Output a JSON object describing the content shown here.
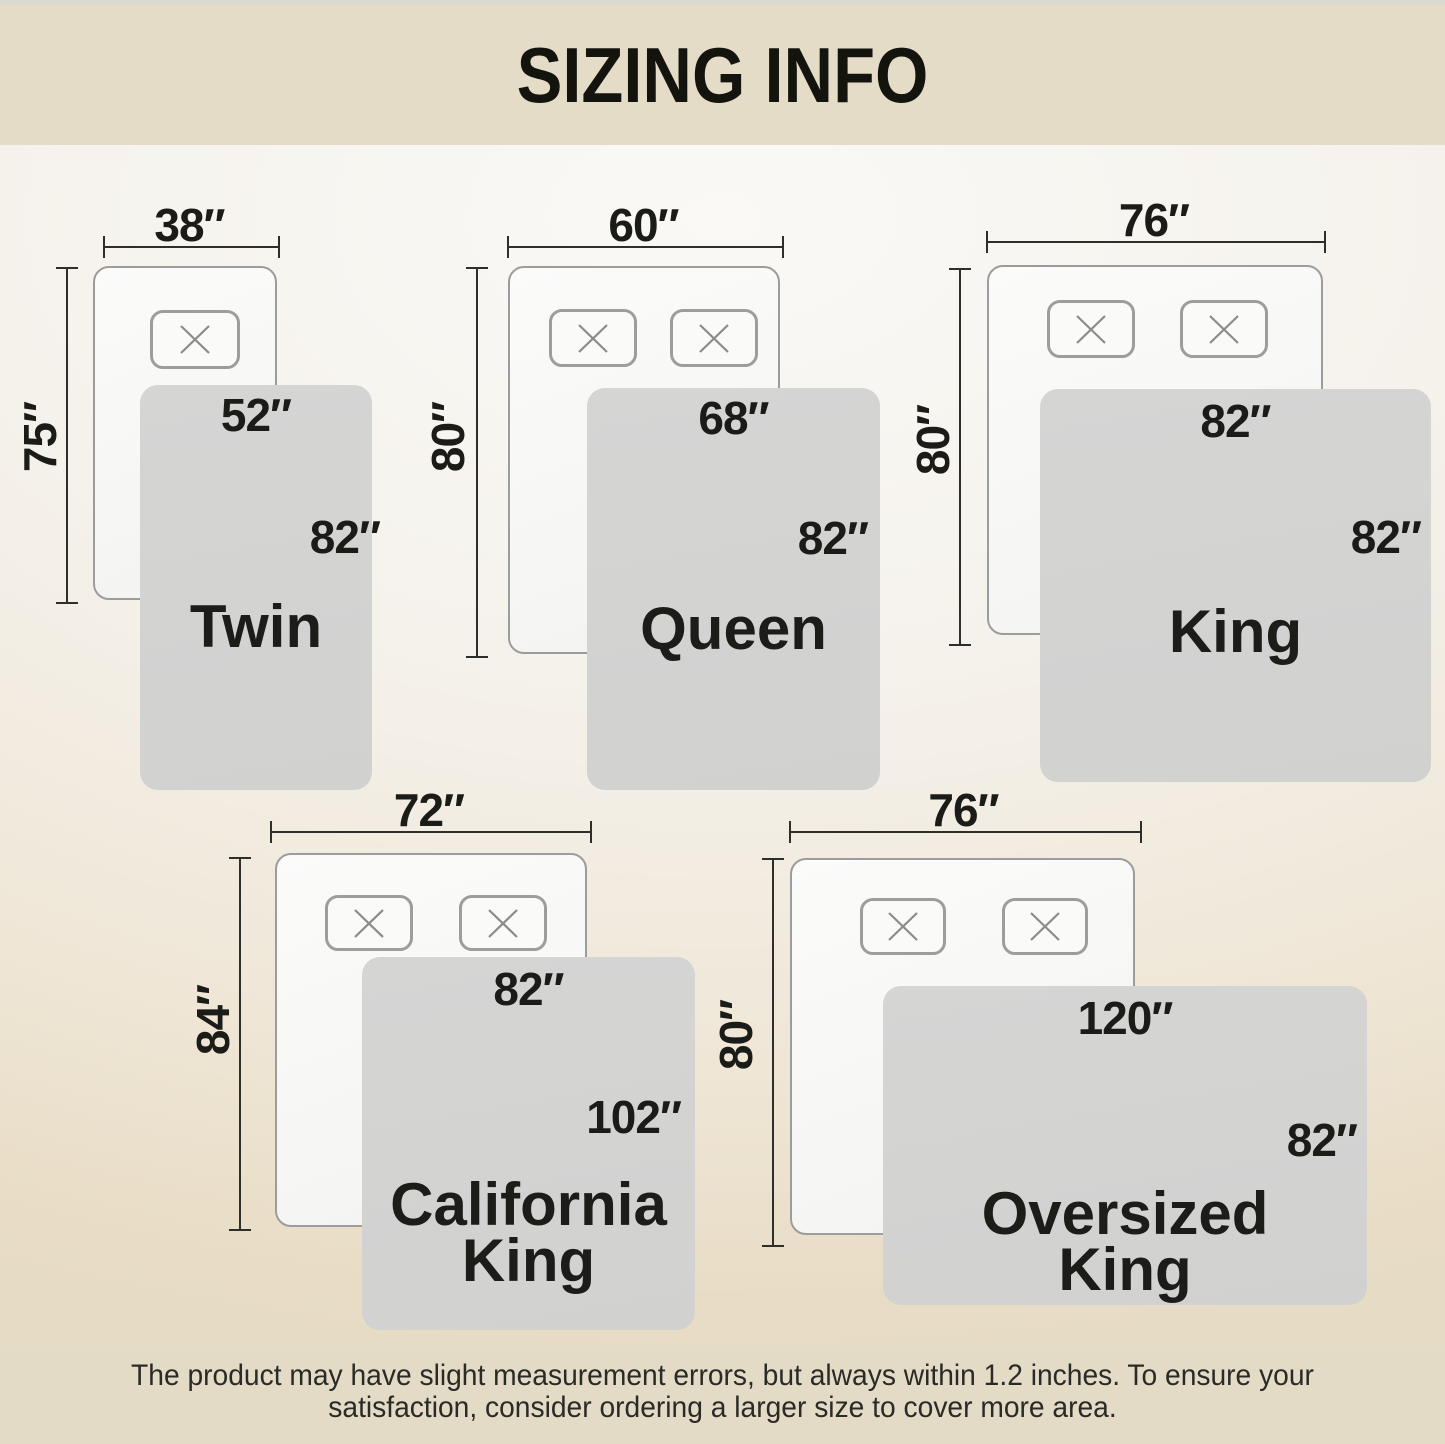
{
  "header": {
    "title": "SIZING INFO"
  },
  "beds": [
    {
      "name": "Twin",
      "bed_width": "38″",
      "bed_length": "75″",
      "blanket_width": "52″",
      "blanket_length": "82″"
    },
    {
      "name": "Queen",
      "bed_width": "60″",
      "bed_length": "80″",
      "blanket_width": "68″",
      "blanket_length": "82″"
    },
    {
      "name": "King",
      "bed_width": "76″",
      "bed_length": "80″",
      "blanket_width": "82″",
      "blanket_length": "82″"
    },
    {
      "name": "California King",
      "bed_width": "72″",
      "bed_length": "84″",
      "blanket_width": "82″",
      "blanket_length": "102″"
    },
    {
      "name": "Oversized King",
      "bed_width": "76″",
      "bed_length": "80″",
      "blanket_width": "120″",
      "blanket_length": "82″"
    }
  ],
  "footer": {
    "line1": "The product may have slight measurement errors, but always within 1.2 inches. To ensure your",
    "line2": "satisfaction, consider ordering a larger size to cover more area."
  },
  "colors": {
    "header_band": "#e5dcc7",
    "footer_band": "#e4dbc6",
    "blanket_gray": "#d3d3d2",
    "bed_border_gray": "#9c9c9c",
    "text_dark": "#1d1d1b"
  }
}
